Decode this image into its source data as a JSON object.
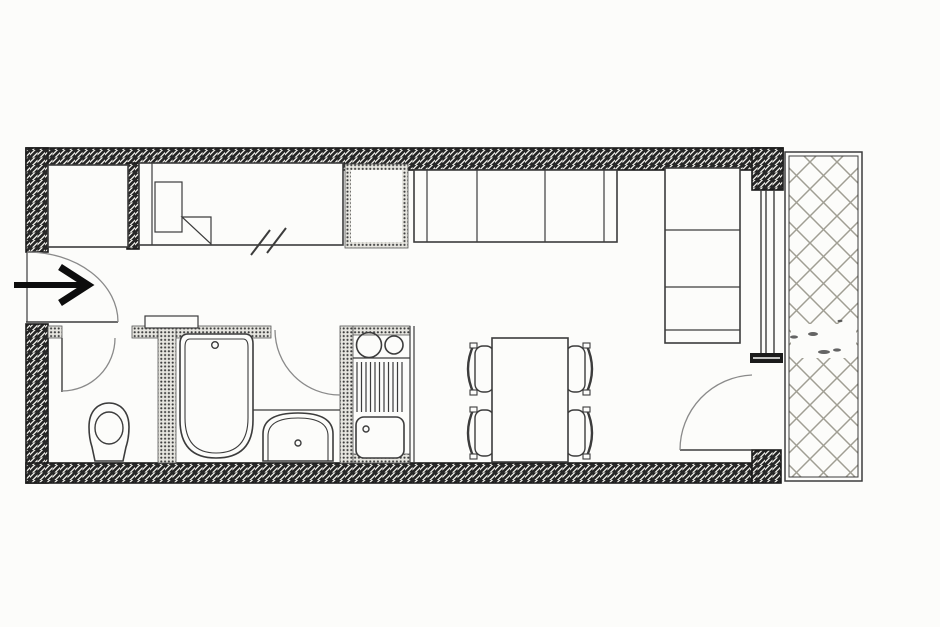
{
  "meta": {
    "title": "Studio apartment floor plan",
    "media": "black-and-white scanned architectural drawing, no text labels visible",
    "visible_text": ""
  },
  "colors": {
    "paper": "#fcfcfa",
    "ink": "#3c3c3c",
    "wall_hatch": "#262626",
    "wall_outline": "#1b1b1b",
    "partition_stipple": "#3b3b3b",
    "partition_bg": "#e6e5df",
    "door_arc": "#8a8a8a",
    "balcony_hatch": "#a09e93",
    "arrow": "#0d0d0d"
  },
  "rooms": [
    {
      "name": "entry-hall",
      "features": [
        "entrance-arrow",
        "entry-door-swing"
      ]
    },
    {
      "name": "wc",
      "features": [
        "toilet",
        "wc-door-swing"
      ]
    },
    {
      "name": "bathroom",
      "features": [
        "bathtub",
        "washbasin",
        "counter",
        "bathroom-door-swing"
      ]
    },
    {
      "name": "kitchenette",
      "features": [
        "two-burner-hob",
        "drainer-counter",
        "kitchen-sink"
      ]
    },
    {
      "name": "living-sleeping-room",
      "features": [
        "single-bed",
        "closet",
        "wardrobe",
        "sofa-horizontal",
        "sofa-vertical",
        "dining-table",
        "four-chairs",
        "window",
        "balcony-door-swing"
      ]
    },
    {
      "name": "balcony",
      "features": [
        "cross-hatched-floor"
      ]
    }
  ],
  "furniture": [
    {
      "name": "closet",
      "room": "living-sleeping-room"
    },
    {
      "name": "single-bed",
      "room": "living-sleeping-room",
      "details": [
        "pillow",
        "folded-cover",
        "double-slash-break-marks"
      ]
    },
    {
      "name": "wardrobe",
      "room": "living-sleeping-room"
    },
    {
      "name": "sofa-horizontal",
      "room": "living-sleeping-room",
      "sections": 3
    },
    {
      "name": "sofa-vertical",
      "room": "living-sleeping-room",
      "sections": 3
    },
    {
      "name": "dining-table",
      "room": "living-sleeping-room",
      "chairs": 4
    },
    {
      "name": "kitchen-unit",
      "room": "kitchenette",
      "details": [
        "burner-large",
        "burner-small",
        "drainer-stripes",
        "sink-with-tap"
      ]
    },
    {
      "name": "bathtub",
      "room": "bathroom",
      "details": [
        "tap-dot"
      ]
    },
    {
      "name": "washbasin",
      "room": "bathroom",
      "details": [
        "tap-dot"
      ]
    },
    {
      "name": "toilet",
      "room": "wc"
    }
  ],
  "symbols": [
    {
      "name": "entrance-arrow",
      "meaning": "main entrance direction"
    },
    {
      "name": "entry-door-swing"
    },
    {
      "name": "wc-door-swing"
    },
    {
      "name": "bathroom-door-swing"
    },
    {
      "name": "balcony-door-swing"
    },
    {
      "name": "window-triple-line"
    },
    {
      "name": "bed-break-slashes"
    },
    {
      "name": "balcony-crosshatch"
    }
  ]
}
